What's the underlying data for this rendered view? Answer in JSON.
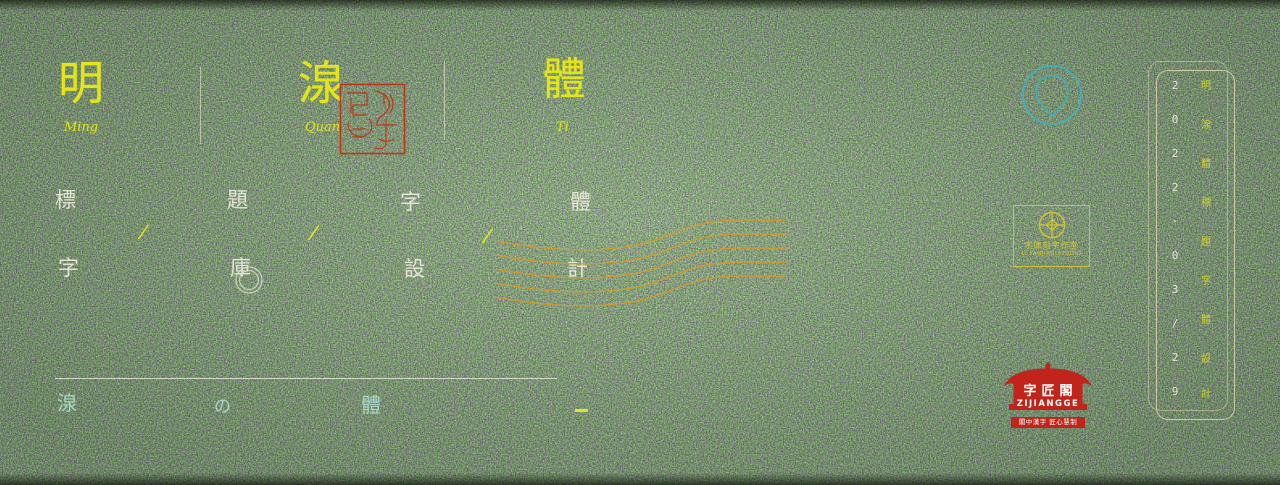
{
  "palette": {
    "background_green": "#3f5a1d",
    "accent_yellow": "#e4e41b",
    "wave_orange": "#d69a2e",
    "logo_cyan": "#3ab4c6",
    "seal_red": "#c0241a",
    "frame_cream": "#d8d2b0",
    "footer_cyan": "#a9d6c8",
    "keyword_white": "#eeebde",
    "stamp_yellow": "#d2c430"
  },
  "title": {
    "items": [
      {
        "char": "明",
        "latin": "Ming"
      },
      {
        "char": "湶",
        "latin": "Quan"
      },
      {
        "char": "體",
        "latin": "Ti"
      }
    ]
  },
  "keywords": {
    "row1": [
      "標",
      "題",
      "字",
      "體"
    ],
    "row2": [
      "字",
      "庫",
      "設",
      "計"
    ],
    "slash": "/"
  },
  "footer": {
    "chars": [
      "湶",
      "の",
      "體"
    ]
  },
  "studio_stamp": {
    "cn": "字庫刻字作室",
    "en": "LI YANJIAO STUDIO"
  },
  "brand": {
    "name_cn": "字匠閣",
    "name_en": "ZIJIANGGE",
    "tagline": "閣中漢字 匠心慧制",
    "trademark": "™"
  },
  "side_panel": {
    "date_chars": [
      "2",
      "0",
      "2",
      "2",
      "·",
      "0",
      "3",
      "/",
      "2",
      "9"
    ],
    "label_chars": [
      "明",
      "湶",
      "體",
      "標",
      "題",
      "字",
      "體",
      "設",
      "計"
    ]
  }
}
